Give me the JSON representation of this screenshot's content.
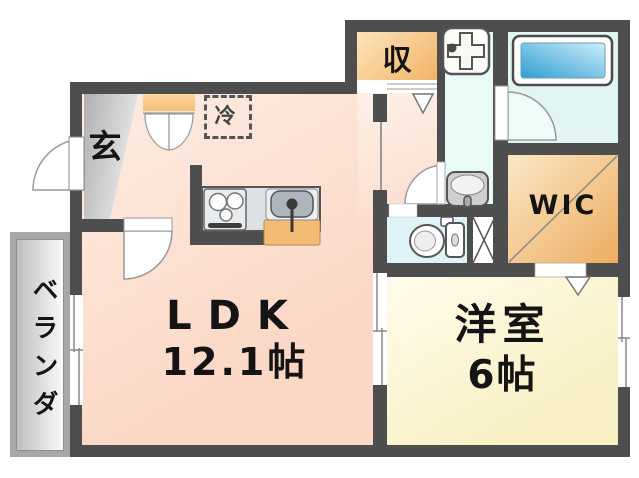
{
  "plan_type": "apartment-floor-plan",
  "rooms": {
    "ldk": {
      "label": "LDK",
      "size": "12.1帖"
    },
    "western": {
      "label": "洋室",
      "size": "6帖"
    },
    "entrance": {
      "label": "玄"
    },
    "closet": {
      "label": "収"
    },
    "wic": {
      "label": "WIC"
    },
    "veranda": {
      "label": "ベランダ"
    },
    "fridge": {
      "label": "冷"
    }
  },
  "fixtures": [
    "bathtub",
    "washing-machine",
    "washbasin",
    "toilet",
    "gas-stove",
    "kitchen-sink",
    "pipe-shaft",
    "refrigerator-space"
  ],
  "colors": {
    "wall": "#4e4e4e",
    "ldk_floor": "#fbd7c5",
    "western_floor": "#f8f0c2",
    "wet_area_floor": "#e1f6f2",
    "storage_orange": "#f2b365",
    "bathtub_blue": "#2f9ed1",
    "entrance_gray": "#b0b0b0",
    "veranda_gray": "#a7a7a7",
    "counter_gray": "#dde1e6",
    "cabinet_orange": "#f2bc77"
  }
}
